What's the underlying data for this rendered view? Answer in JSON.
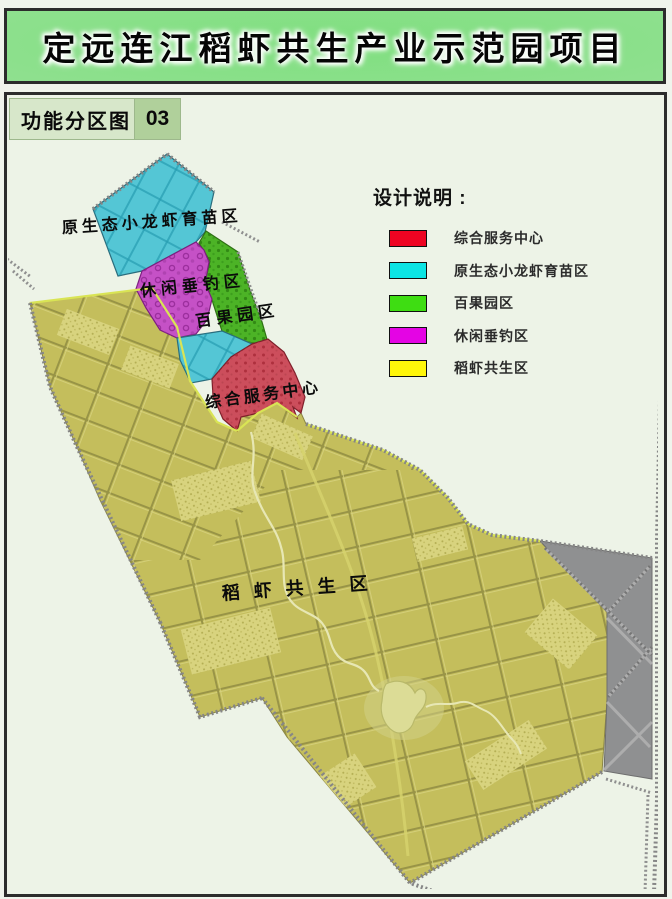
{
  "page": {
    "title": "定远连江稻虾共生产业示范园项目"
  },
  "header": {
    "label": "功能分区图",
    "number": "03"
  },
  "legend": {
    "title": "设计说明 :",
    "items": [
      {
        "label": "综合服务中心",
        "color": "#ee0422"
      },
      {
        "label": "原生态小龙虾育苗区",
        "color": "#0ce4e4"
      },
      {
        "label": "百果园区",
        "color": "#3edd12"
      },
      {
        "label": "休闲垂钓区",
        "color": "#e404e4"
      },
      {
        "label": "稻虾共生区",
        "color": "#fff60a"
      }
    ]
  },
  "map_labels": {
    "crayfish_nursery": "原生态小龙虾育苗区",
    "leisure_fishing": "休闲垂钓区",
    "fruit_orchard": "百果园区",
    "service_center": "综合服务中心",
    "rice_shrimp": "稻虾共生区"
  },
  "map_colors": {
    "rice_shrimp_fill": "#c4be5c",
    "crayfish_fill": "#54c6d5",
    "fishing_fill": "#c551c6",
    "orchard_fill": "#4cb326",
    "service_fill": "#cc4e5c",
    "urban_gray_fill": "#8f9091",
    "pond_fill": "#dcdc96",
    "map_background": "#edf3e7"
  }
}
